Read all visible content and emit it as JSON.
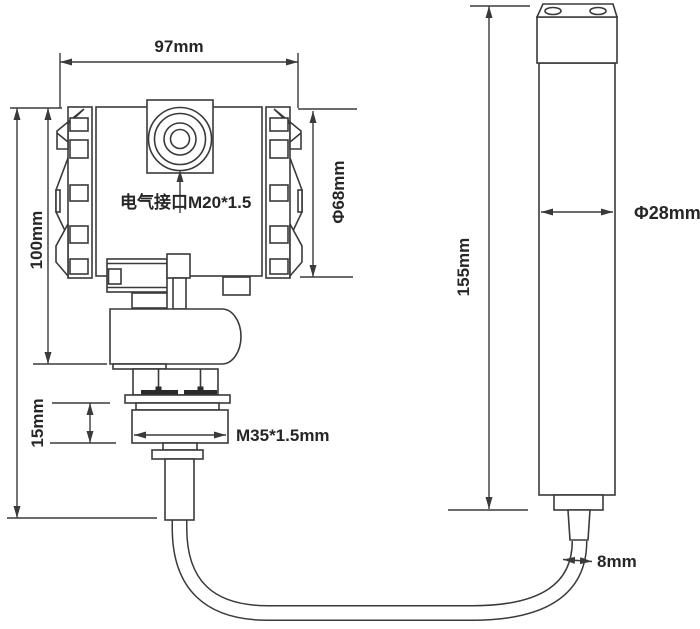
{
  "colors": {
    "line": "#3a3a3a",
    "text": "#262626",
    "bolt_fill": "#2a2a2a",
    "background": "#ffffff"
  },
  "transmitter": {
    "dim_width": "97mm",
    "dim_height": "100mm",
    "dim_body_diameter": "Φ68mm",
    "label_electrical_port": "电气接口M20*1.5",
    "dim_thread_height": "15mm",
    "dim_thread_spec": "M35*1.5mm"
  },
  "probe": {
    "dim_length": "155mm",
    "dim_diameter": "Φ28mm",
    "dim_cable_diameter": "8mm"
  }
}
